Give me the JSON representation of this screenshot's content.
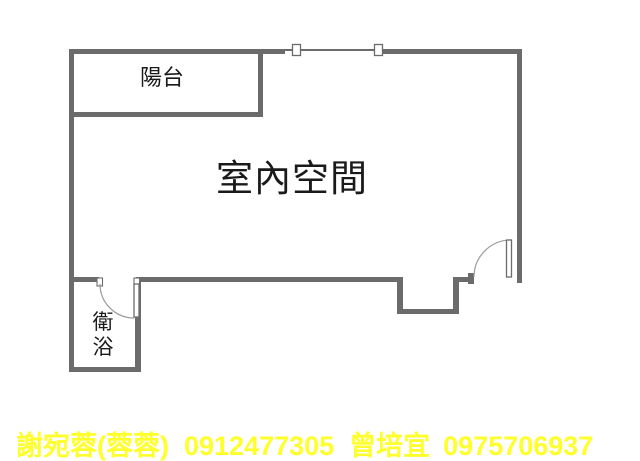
{
  "plan": {
    "balcony_label": "陽台",
    "indoor_label": "室內空間",
    "bathroom_label_char1": "衛",
    "bathroom_label_char2": "浴",
    "colors": {
      "wall": "#6b6b6b",
      "door_arc": "#9a9a9a",
      "room_label": "#1a1a1a"
    }
  },
  "footer": {
    "agent1_name": "謝宛蓉(蓉蓉)",
    "agent1_phone": "0912477305",
    "agent2_name": "曾培宜",
    "agent2_phone": "0975706937",
    "text_color": "#ffff2d"
  }
}
